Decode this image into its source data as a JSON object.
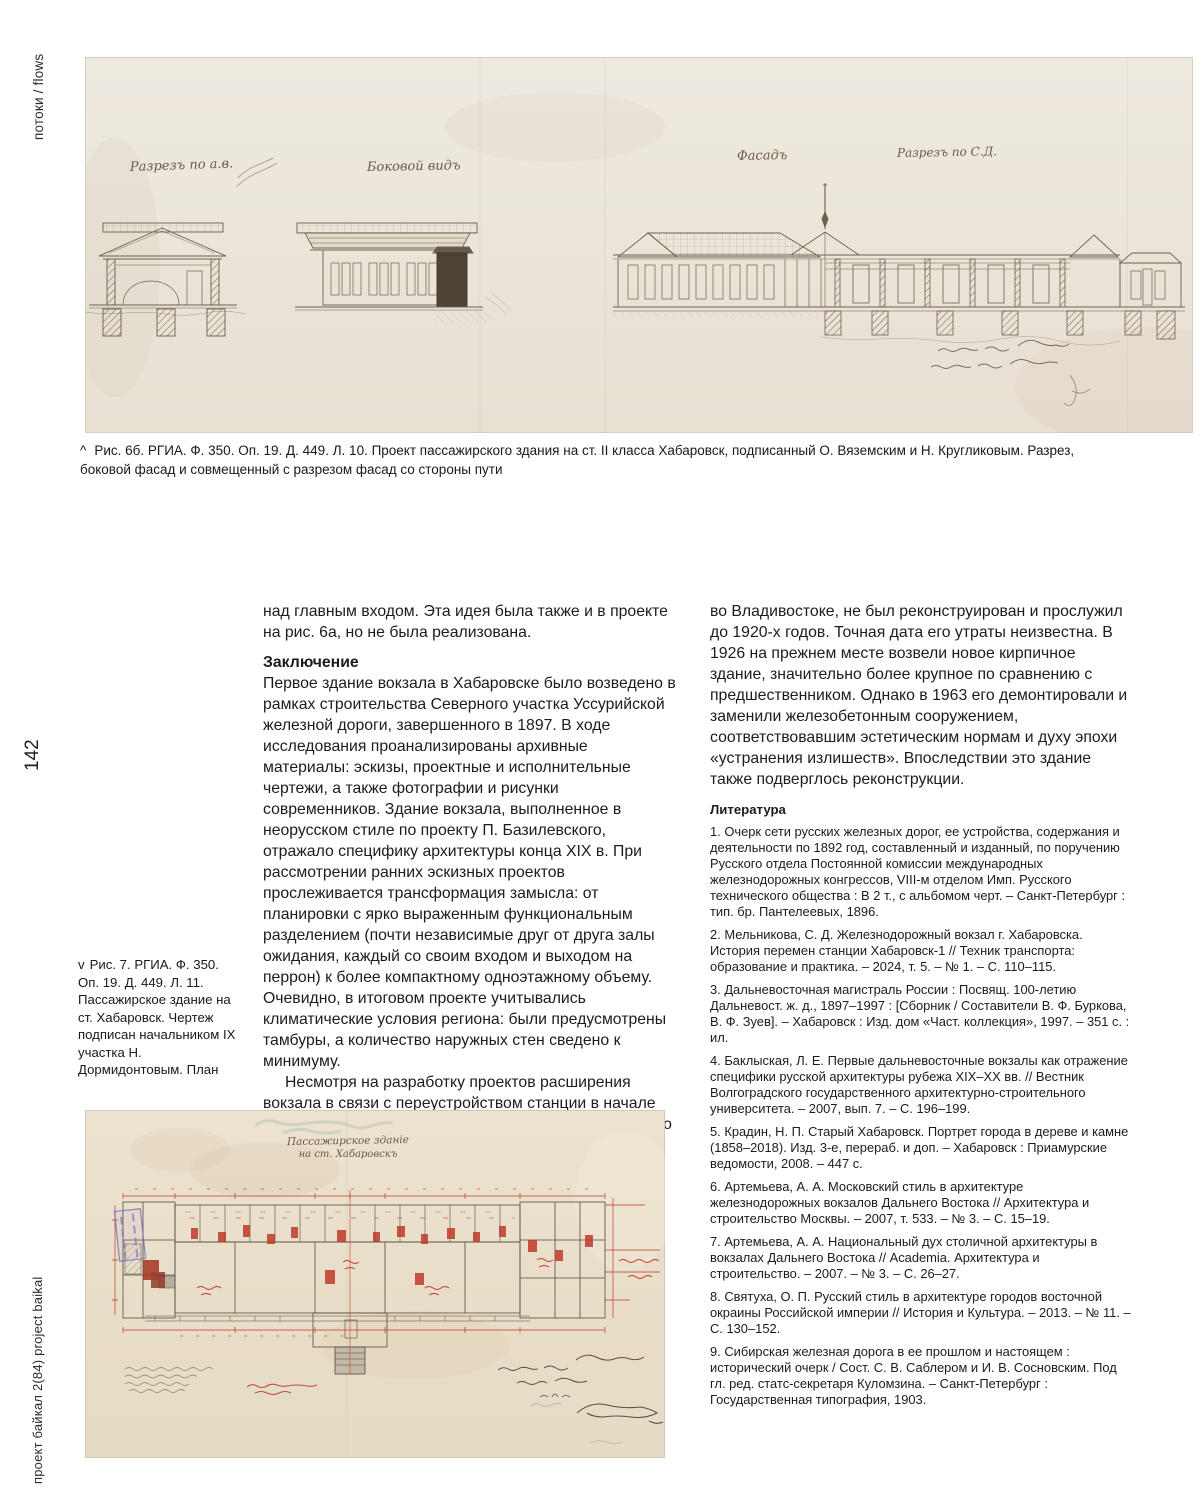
{
  "page": {
    "rubric": "потоки / flows",
    "page_number": "142",
    "journal_label": "проект байкал 2(84) project baikal"
  },
  "figure6": {
    "marker": "^",
    "caption": "Рис. 6б. РГИА. Ф. 350. Оп. 19. Д. 449. Л. 10. Проект пассажирского здания на ст. II класса Хабаровск, подписанный О. Вяземским и Н. Кругликовым. Разрез, боковой фасад и совмещенный с разрезом фасад со стороны пути",
    "labels": {
      "section_ab": "Разрезъ по а.в.",
      "side_view": "Боковой видъ",
      "facade": "Фасадъ",
      "section_cd": "Разрезъ по С.Д."
    }
  },
  "figure7": {
    "marker": "v",
    "caption": "Рис. 7. РГИА. Ф. 350. Оп. 19. Д. 449. Л. 11. Пассажирское здание на ст. Хабаровск. Чертеж подписан начальником IX участка Н. Дормидонтовым. План",
    "plan_title_line1": "Пассажирское зданіе",
    "plan_title_line2": "на ст. Хабаровскъ"
  },
  "article": {
    "col1": {
      "para0": "над главным входом. Эта идея была также и в проекте на рис. 6а, но не была реализована.",
      "heading": "Заключение",
      "para1": "Первое здание вокзала в Хабаровске было возведено в рамках строительства Северного участка Уссурийской железной дороги, завершенного в 1897. В ходе исследования проанализированы архивные материалы: эскизы, проектные и исполнительные чертежи, а также фотографии и рисунки современников. Здание вокзала, выполненное в неорусском стиле по проекту П. Базилевского, отражало специфику архитектуры конца XIX в. При рассмотрении ранних эскизных проектов прослеживается трансформация замысла: от планировки с ярко выраженным функциональным разделением (почти независимые друг от друга залы ожидания, каждый со своим входом и выходом на перрон) к более компактному одноэтажному объему. Очевидно, в итоговом проекте учитывались климатические условия региона: были предусмотрены тамбуры, а количество наружных стен сведено к минимуму.",
      "para2": "Несмотря на разработку проектов расширения вокзала в связи с переустройством станции в начале XX в., первый вокзал Хабаровска, в отличие от первого вокзала"
    },
    "col2": {
      "para1": "во Владивостоке, не был реконструирован и прослужил до 1920-х годов. Точная дата его утраты неизвестна. В 1926 на прежнем месте возвели новое кирпичное здание, значительно более крупное по сравнению с предшественником. Однако в 1963 его демонтировали и заменили железобетонным сооружением, соответствовавшим эстетическим нормам и духу эпохи «устранения излишеств». Впоследствии это здание также подверглось реконструкции.",
      "heading": "Литература",
      "references": [
        "1. Очерк сети русских железных дорог, ее устройства, содержания и деятельности по 1892 год, составленный и изданный, по поручению Русского отдела Постоянной комиссии международных железнодорожных конгрессов, VIII-м отделом Имп. Русского технического общества : В 2 т., с альбомом черт. – Санкт-Петербург : тип. бр. Пантелеевых, 1896.",
        "2. Мельникова, С. Д. Железнодорожный вокзал г. Хабаровска. История перемен станции Хабаровск-1 // Техник транспорта: образование и практика. – 2024, т. 5. – № 1. – С. 110–115.",
        "3. Дальневосточная магистраль России : Посвящ. 100-летию Дальневост. ж. д., 1897–1997 : [Сборник / Составители В. Ф. Буркова, В. Ф. Зуев]. – Хабаровск : Изд. дом «Част. коллекция», 1997. – 351 с. : ил.",
        "4. Баклыская, Л. Е. Первые дальневосточные вокзалы как отражение специфики русской архитектуры рубежа XIX–XX вв. // Вестник Волгоградского государственного архитектурно-строительного университета. – 2007, вып. 7. – С. 196–199.",
        "5. Крадин, Н. П. Старый Хабаровск. Портрет города в дереве и камне (1858–2018). Изд. 3-е, перераб. и доп. – Хабаровск : Приамурские ведомости, 2008. – 447 с.",
        "6. Артемьева, А. А. Московский стиль в архитектуре железнодорожных вокзалов Дальнего Востока // Архитектура и строительство Москвы. – 2007, т. 533. – № 3. – С. 15–19.",
        "7. Артемьева, А. А. Национальный дух столичной архитектуры в вокзалах Дальнего Востока // Academia. Архитектура и строительство. – 2007. – № 3. – С. 26–27.",
        "8. Святуха, О. П. Русский стиль в архитектуре городов восточной окраины Российской империи // История и Культура. – 2013. – № 11. – С. 130–152.",
        "9. Сибирская железная дорога в ее прошлом и настоящем : исторический очерк / Сост. С. В. Саблером и И. В. Сосновским. Под гл. ред. статс-секретаря Куломзина. – Санкт-Петербург : Государственная типография, 1903."
      ]
    }
  }
}
